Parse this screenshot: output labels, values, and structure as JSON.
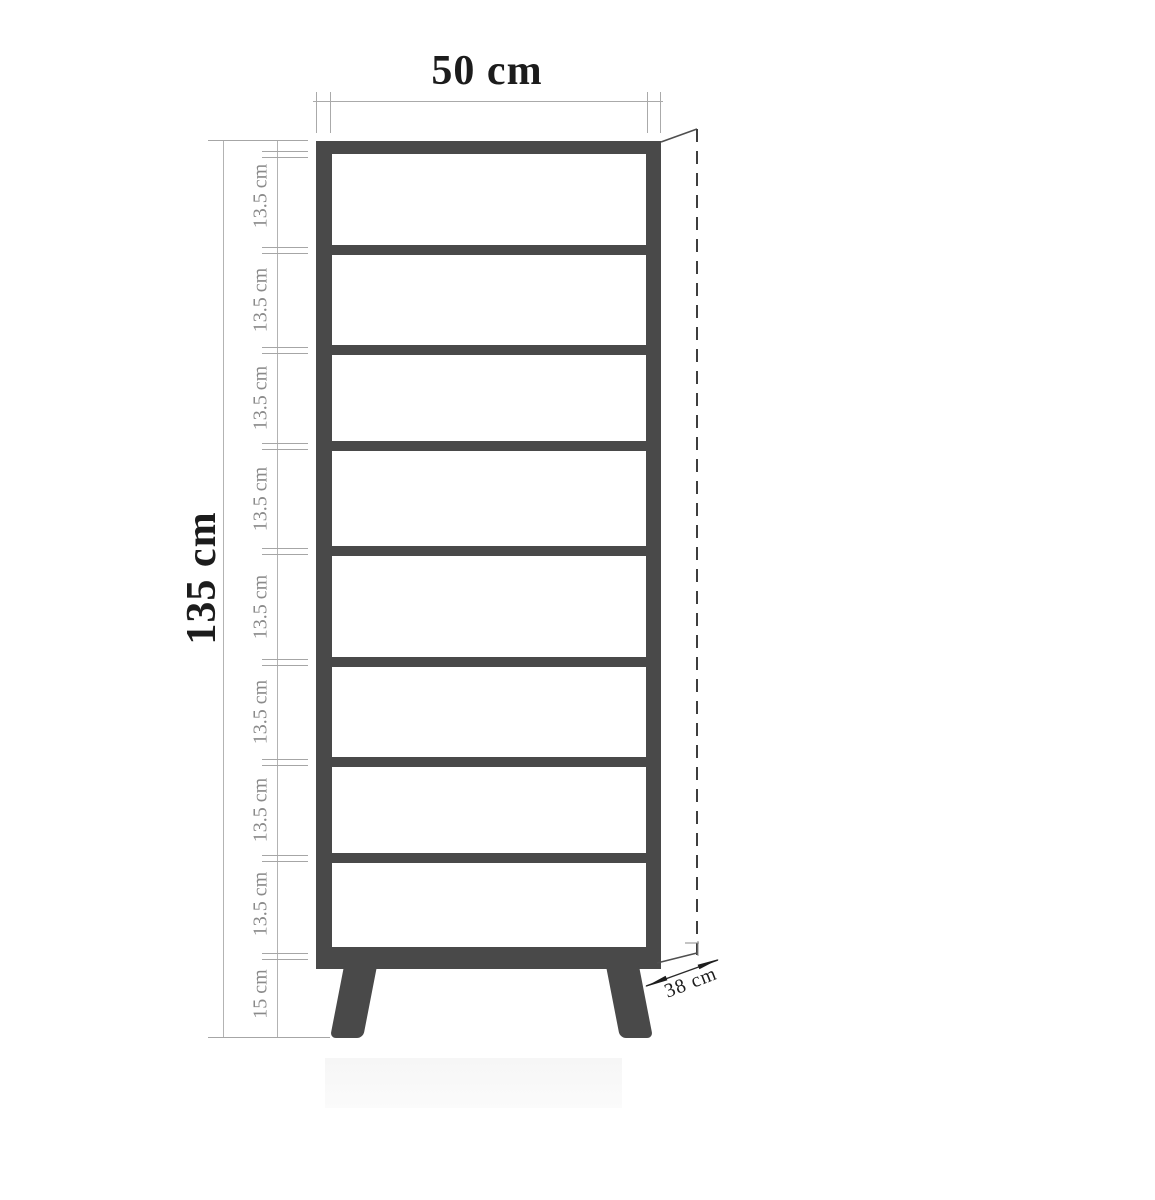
{
  "diagram": {
    "width_label": "50 cm",
    "height_label": "135 cm",
    "depth_label": "38 cm",
    "segment_labels": [
      "13.5 cm",
      "13.5 cm",
      "13.5 cm",
      "13.5 cm",
      "13.5 cm",
      "13.5 cm",
      "13.5 cm",
      "13.5 cm"
    ],
    "base_label": "15 cm",
    "dimensions": {
      "width_cm": 50,
      "height_cm": 135,
      "depth_cm": 38,
      "compartment_height_cm": 13.5,
      "compartment_count": 8,
      "shelf_count": 7,
      "leg_height_cm": 15
    },
    "colors": {
      "frame": "#494949",
      "dimension_lines": "#aaaaaa",
      "secondary_text": "#8a8a8a",
      "primary_text": "#1c1c1c",
      "background": "#ffffff"
    }
  }
}
